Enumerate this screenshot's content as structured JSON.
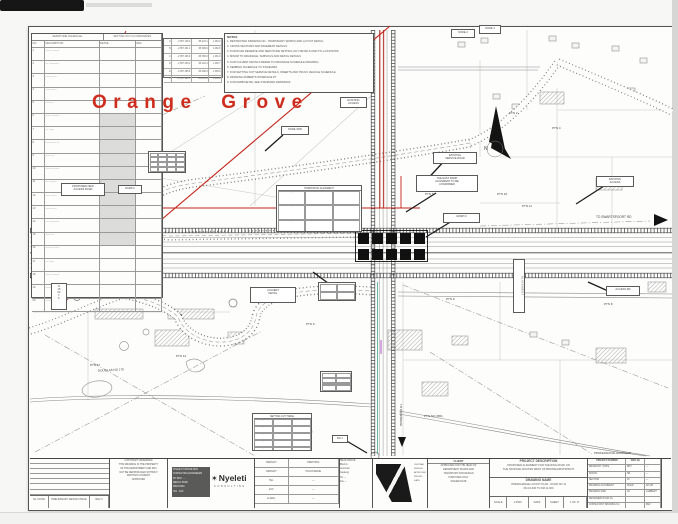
{
  "plan": {
    "area_title": "Orange Grove",
    "north_letter": "N"
  },
  "colors": {
    "boundary_red": "#c4251c",
    "title_red": "#ce2d1d",
    "teal_marking": "#2f9d87",
    "paper": "#fdfdfc"
  },
  "notes": {
    "header": "NOTES",
    "lines": [
      "RESTRICTED DRAWING NO - TEMPORARY WORKS AND LAYOUT DETAIL",
      "CROSS SECTIONS AND PAVEMENT DETAILS",
      "FOR ROAD RESERVE AND SERVITUDE SETTING OUT DETAILS AND PTL LOCATIONS",
      "MINOR TO DRAINAGE, SUBSOILS AND DETAIL DETAILS",
      "FOR CULVERT DETAILS REFER TO DRAINAGE SCHEDULE DRAWING",
      "KERBING SCHEDULE TO STANDARD",
      "FOR SETTING OUT SERVICE DETAILS, INSERTS AND TRUCK VEHICLE SCHEDULE",
      "DRAWING ROBERTS INTERFACE PT",
      "FOR KERB DETAIL SEE STANDARD DRAWINGS"
    ]
  },
  "schedule": {
    "title_left": "SERVITUDE SCHEDULE",
    "title_right": "SETTING OUT CO-ORDINATES",
    "col_headers": [
      "NO",
      "DESCRIPTION",
      "DETAIL",
      "REF"
    ],
    "rows": [
      [
        "1",
        "—— ———",
        "",
        ""
      ],
      [
        "2",
        "— ————",
        "··",
        ""
      ],
      [
        "3",
        "——— —",
        "",
        ""
      ],
      [
        "4",
        "—— ——",
        "··",
        ""
      ],
      [
        "5",
        "———",
        "",
        ""
      ],
      [
        "6",
        "—— ———",
        "··",
        ""
      ],
      [
        "7",
        "— ——",
        "",
        ""
      ],
      [
        "8",
        "———— —",
        "··",
        "·"
      ],
      [
        "9",
        "—— —",
        "··",
        ""
      ],
      [
        "10",
        "——— ——",
        "",
        "·"
      ],
      [
        "11",
        "— ———",
        "··",
        ""
      ],
      [
        "12",
        "—— ——",
        "",
        ""
      ],
      [
        "13",
        "——— —",
        "··",
        "·"
      ],
      [
        "14",
        "— ————",
        "",
        ""
      ],
      [
        "15",
        "—— —",
        "··",
        ""
      ],
      [
        "16",
        "——— ——",
        "",
        ""
      ],
      [
        "17",
        "— ——",
        "··",
        ""
      ],
      [
        "18",
        "—— ———",
        "",
        ""
      ],
      [
        "19",
        "———",
        "··",
        ""
      ],
      [
        "20",
        "—— ——",
        "",
        ""
      ]
    ],
    "coord_rows": [
      [
        "A",
        "-2 857 139.0",
        "-58 423.1",
        "1 463.2"
      ],
      [
        "B",
        "-2 857 201.4",
        "-58 389.6",
        "1 462.8"
      ],
      [
        "C",
        "-2 857 266.9",
        "-58 356.0",
        "1 461.9"
      ],
      [
        "D",
        "-2 857 330.2",
        "-58 322.4",
        "1 460.7"
      ],
      [
        "E",
        "-2 857 395.8",
        "-58 288.9",
        "1 459.6"
      ],
      [
        "F",
        "-2 857 461.3",
        "-58 255.3",
        "1 458.4"
      ]
    ]
  },
  "labels": [
    {
      "x": 281,
      "y": 126,
      "w": 28,
      "h": 9,
      "lines": [
        "NODE 1500"
      ]
    },
    {
      "x": 340,
      "y": 97,
      "w": 27,
      "h": 11,
      "lines": [
        "EXISTING",
        "ACCESS"
      ]
    },
    {
      "x": 118,
      "y": 185,
      "w": 24,
      "h": 9,
      "lines": [
        "RAMP A"
      ]
    },
    {
      "x": 61,
      "y": 183,
      "w": 44,
      "h": 13,
      "lines": [
        "PROPOSED NEW",
        "ACCESS ROAD"
      ]
    },
    {
      "x": 433,
      "y": 152,
      "w": 44,
      "h": 12,
      "lines": [
        "EXISTING",
        "SERVICE ROAD"
      ]
    },
    {
      "x": 416,
      "y": 175,
      "w": 62,
      "h": 17,
      "lines": [
        "THE EAST RAMP",
        "ALIGNMENT TO BE",
        "CONFIRMED"
      ]
    },
    {
      "x": 443,
      "y": 213,
      "w": 37,
      "h": 10,
      "lines": [
        "RAMP D"
      ]
    },
    {
      "x": 596,
      "y": 176,
      "w": 38,
      "h": 11,
      "lines": [
        "EXISTING",
        "ACCESS"
      ]
    },
    {
      "x": 606,
      "y": 286,
      "w": 34,
      "h": 10,
      "lines": [
        "ACCESS RD"
      ]
    },
    {
      "x": 513,
      "y": 259,
      "w": 12,
      "h": 54,
      "v": true,
      "lines": [
        "ALIGNMENT"
      ]
    },
    {
      "x": 332,
      "y": 435,
      "w": 16,
      "h": 8,
      "lines": [
        "BH 1"
      ]
    },
    {
      "x": 51,
      "y": 283,
      "w": 16,
      "h": 27,
      "lines": [
        "N",
        "15",
        "02",
        "Y·",
        "X·"
      ]
    },
    {
      "x": 148,
      "y": 151,
      "w": 38,
      "h": 22,
      "grid": {
        "rows": 4,
        "cols": 4
      }
    },
    {
      "x": 320,
      "y": 371,
      "w": 32,
      "h": 21,
      "grid": {
        "rows": 4,
        "cols": 2
      }
    },
    {
      "x": 252,
      "y": 413,
      "w": 60,
      "h": 38,
      "header": "SETTING OUT TABLE",
      "grid": {
        "rows": 5,
        "cols": 3
      }
    },
    {
      "x": 276,
      "y": 185,
      "w": 86,
      "h": 47,
      "header": "HORIZONTAL ALIGNMENT",
      "grid": {
        "rows": 3,
        "cols": 3
      }
    },
    {
      "x": 318,
      "y": 282,
      "w": 38,
      "h": 19,
      "grid": {
        "rows": 2,
        "cols": 2
      }
    },
    {
      "x": 250,
      "y": 287,
      "w": 46,
      "h": 16,
      "lines": [
        "CULVERT",
        "DETAIL"
      ]
    },
    {
      "x": 451,
      "y": 29,
      "w": 24,
      "h": 9,
      "lines": [
        "NODE 2"
      ]
    },
    {
      "x": 479,
      "y": 25,
      "w": 22,
      "h": 9,
      "lines": [
        "NODE 3"
      ]
    }
  ],
  "texts": [
    {
      "x": 484,
      "y": 147,
      "t": "N",
      "s": 5
    },
    {
      "x": 596,
      "y": 216,
      "t": "TO SWARTSPOORT RD",
      "s": 3.2
    },
    {
      "x": 40,
      "y": 273,
      "t": "TO 1518",
      "s": 3.4
    },
    {
      "x": 68,
      "y": 274,
      "t": "VIEW PTN 3",
      "s": 3
    },
    {
      "x": 509,
      "y": 112,
      "t": "PTN 2",
      "s": 3
    },
    {
      "x": 552,
      "y": 127,
      "t": "PTN 4",
      "s": 3
    },
    {
      "x": 425,
      "y": 193,
      "t": "PTN 5",
      "s": 3
    },
    {
      "x": 497,
      "y": 193,
      "t": "PTN 10",
      "s": 3
    },
    {
      "x": 522,
      "y": 205,
      "t": "PTN 11",
      "s": 3
    },
    {
      "x": 604,
      "y": 303,
      "t": "PTN 8",
      "s": 3
    },
    {
      "x": 176,
      "y": 355,
      "t": "PTN 12",
      "s": 3
    },
    {
      "x": 90,
      "y": 364,
      "t": "PTN 17",
      "s": 3
    },
    {
      "x": 306,
      "y": 323,
      "t": "PTN 6",
      "s": 3
    },
    {
      "x": 446,
      "y": 298,
      "t": "PTN 9",
      "s": 3
    },
    {
      "x": 98,
      "y": 369,
      "t": "DOUGLAS NO 179",
      "s": 3,
      "r": -3
    },
    {
      "x": 424,
      "y": 415,
      "t": "PTN NO 3651",
      "s": 3
    },
    {
      "x": 288,
      "y": 431,
      "t": "MAGRIETA NO 295",
      "s": 2.8,
      "r": -2
    },
    {
      "x": 360,
      "y": 40,
      "t": "HELGAARD STR",
      "s": 3,
      "v": true
    },
    {
      "x": 399,
      "y": 404,
      "t": "TO BRONBERG",
      "s": 3,
      "v": true
    },
    {
      "x": 594,
      "y": 452,
      "t": "PROFESSIONAL ENGINEER",
      "s": 2.8
    }
  ],
  "titleblock": {
    "revision": {
      "row_count": 7,
      "footer": {
        "c1": "No / DATE",
        "c2": "PRELIMINARY DESIGN ISSUE",
        "c3": "REV 0"
      }
    },
    "copyright": {
      "lines": [
        "COPYRIGHT RESERVED",
        "THIS DRAWING IS THE PROPERTY",
        "OF THE DEPARTMENT AND MAY",
        "NOT BE REPRODUCED WITHOUT",
        "WRITTEN CONSENT",
        "APPROVED"
      ]
    },
    "brand": {
      "star": "✶",
      "name": "Nyeleti",
      "sub": "CONSULTING",
      "address_lines": [
        "NYELETI CONSULTING",
        "CONSULTING ENGINEERS",
        "PO BOX ·····",
        "MENLO PARK",
        "PRETORIA",
        "TEL · FAX"
      ]
    },
    "contacts": {
      "rows": [
        [
          "BRANCH",
          "PRETORIA"
        ],
        [
          "BRANCH",
          "POLOKWANE"
        ],
        [
          "TEL",
          "—"
        ],
        [
          "FAX",
          "—"
        ],
        [
          "E-MAIL",
          "—"
        ]
      ]
    },
    "headoffice": {
      "lines": [
        "HEAD OFFICE",
        "Block A",
        "Centurion",
        "Gauteng",
        "Tel —",
        "Fax —"
      ]
    },
    "design": {
      "lines": [
        "CENTRAL",
        "DESIGN",
        "APPROVED",
        "PR ENG",
        "DATE"
      ]
    },
    "client": {
      "header": "CLIENT",
      "lines": [
        "APPROVED FOR THE HEAD OF",
        "DEPARTMENT ROADS AND",
        "TRANSPORT FOR DESIGN",
        "PURPOSES ONLY",
        "SIGNED        DATE"
      ]
    },
    "project": {
      "desc_header": "PROJECT DESCRIPTION",
      "desc_lines": [
        "PROPOSED ALIGNMENT FOR THE RING ROAD ON",
        "THE NATIONAL ROUTES WEST OF BRONKHORSTSPRUIT"
      ],
      "name_header": "DRAWING NAME",
      "name_lines": [
        "INTERCHANGE LAYOUT PLAN - ROAD NO 11",
        "KM 10.000 TO KM 11.000"
      ],
      "footer_cells": [
        "SCALE",
        "1:2500",
        "DATE",
        "SHEET",
        "1 OF 17"
      ]
    },
    "number": {
      "rows": [
        [
          "PROJECT NUMBER",
          "DWG No",
          ""
        ],
        [
          "DRAWN BY / DATE",
          "RPV",
          "—"
        ],
        [
          "ROUTE",
          "NR",
          "—"
        ],
        [
          "SECTION",
          "16",
          "—"
        ],
        [
          "DRAWING ALIGNMENT",
          "ROAD",
          "AP-NO"
        ],
        [
          "DRAWING SIZE",
          "A0",
          "LAMBERT"
        ],
        [
          "DESIGNERS PLAN No",
          "",
          ""
        ],
        [
          "CONSULTANT DRAWING No",
          "",
          "REV"
        ],
        [
          "DEPT DOCUMENT No",
          "",
          ""
        ]
      ]
    }
  }
}
